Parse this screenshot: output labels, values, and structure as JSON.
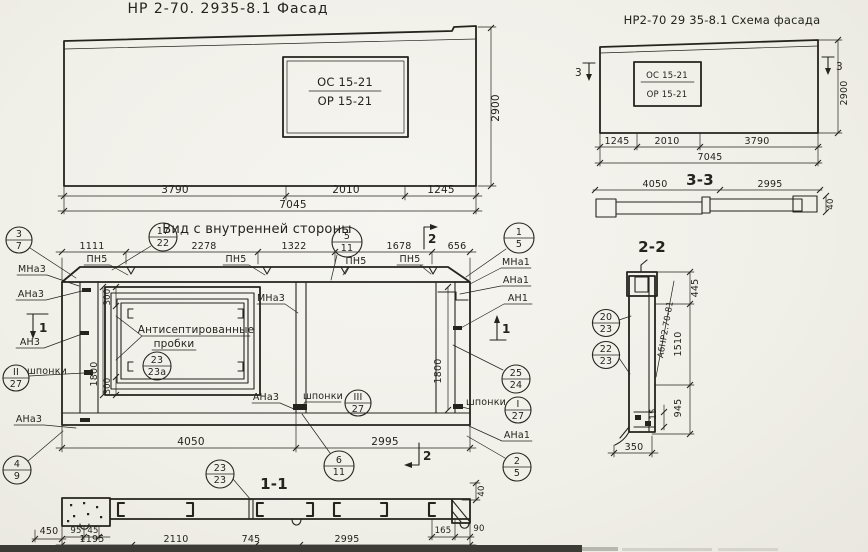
{
  "colors": {
    "paper": "#f0efe8",
    "ink": "#24231d"
  },
  "facade": {
    "title": "НР 2-70. 2935-8.1 Фасад",
    "win_top": "ОС 15-21",
    "win_bottom": "ОР 15-21",
    "d1": "3790",
    "d2": "2010",
    "d3": "1245",
    "total": "7045",
    "h": "2900"
  },
  "schema": {
    "title": "НР2-70 29 35-8.1 Схема фасада",
    "win_top": "ОС 15-21",
    "win_bottom": "ОР 15-21",
    "d1": "1245",
    "d2": "2010",
    "d3": "3790",
    "total": "7045",
    "h": "2900",
    "mark": "3"
  },
  "s33": {
    "label": "3-3",
    "d1": "4050",
    "d2": "2995",
    "t": "40"
  },
  "s22": {
    "label": "2-2",
    "part": "АбНР2.70-81",
    "d445": "445",
    "d1510": "1510",
    "d945": "945",
    "d15": "15",
    "d350": "350"
  },
  "inner": {
    "title": "Вид с внутренней стороны",
    "dims_top": [
      "1111",
      "2278",
      "1322",
      "1678",
      "656"
    ],
    "dims_bottom": [
      "4050",
      "2995"
    ],
    "d300": "300",
    "d1800": "1800",
    "note1": "Антисептированные",
    "note2": "пробки",
    "mark1": "1",
    "mark2": "2"
  },
  "s11": {
    "label": "1-1",
    "dims_row": [
      "1195",
      "2110",
      "745",
      "2995"
    ],
    "d450": "450",
    "d95": "95",
    "d45": "45",
    "d165": "165",
    "d90": "90",
    "d40": "40"
  },
  "labels": {
    "pn5": "ПН5",
    "mna3": "МНа3",
    "ana3": "АНа3",
    "an3": "АН3",
    "mna1": "МНа1",
    "ana1": "АНа1",
    "an1": "АН1",
    "shponki": "шпонки"
  },
  "callouts": {
    "c3_7": {
      "top": "3",
      "bottom": "7"
    },
    "c17_22": {
      "top": "17",
      "bottom": "22"
    },
    "c5_11": {
      "top": "5",
      "bottom": "11"
    },
    "c1_5": {
      "top": "1",
      "bottom": "5"
    },
    "c2_5": {
      "top": "2",
      "bottom": "5"
    },
    "c4_9": {
      "top": "4",
      "bottom": "9"
    },
    "c6_11": {
      "top": "6",
      "bottom": "11"
    },
    "c25_24": {
      "top": "25",
      "bottom": "24"
    },
    "cI_27": {
      "top": "I",
      "bottom": "27"
    },
    "cII_27": {
      "top": "II",
      "bottom": "27"
    },
    "cIII_27": {
      "top": "III",
      "bottom": "27"
    },
    "c23_23a": {
      "top": "23",
      "bottom": "23а"
    },
    "c23_23": {
      "top": "23",
      "bottom": "23"
    },
    "c20_23": {
      "top": "20",
      "bottom": "23"
    },
    "c22_23": {
      "top": "22",
      "bottom": "23"
    }
  }
}
